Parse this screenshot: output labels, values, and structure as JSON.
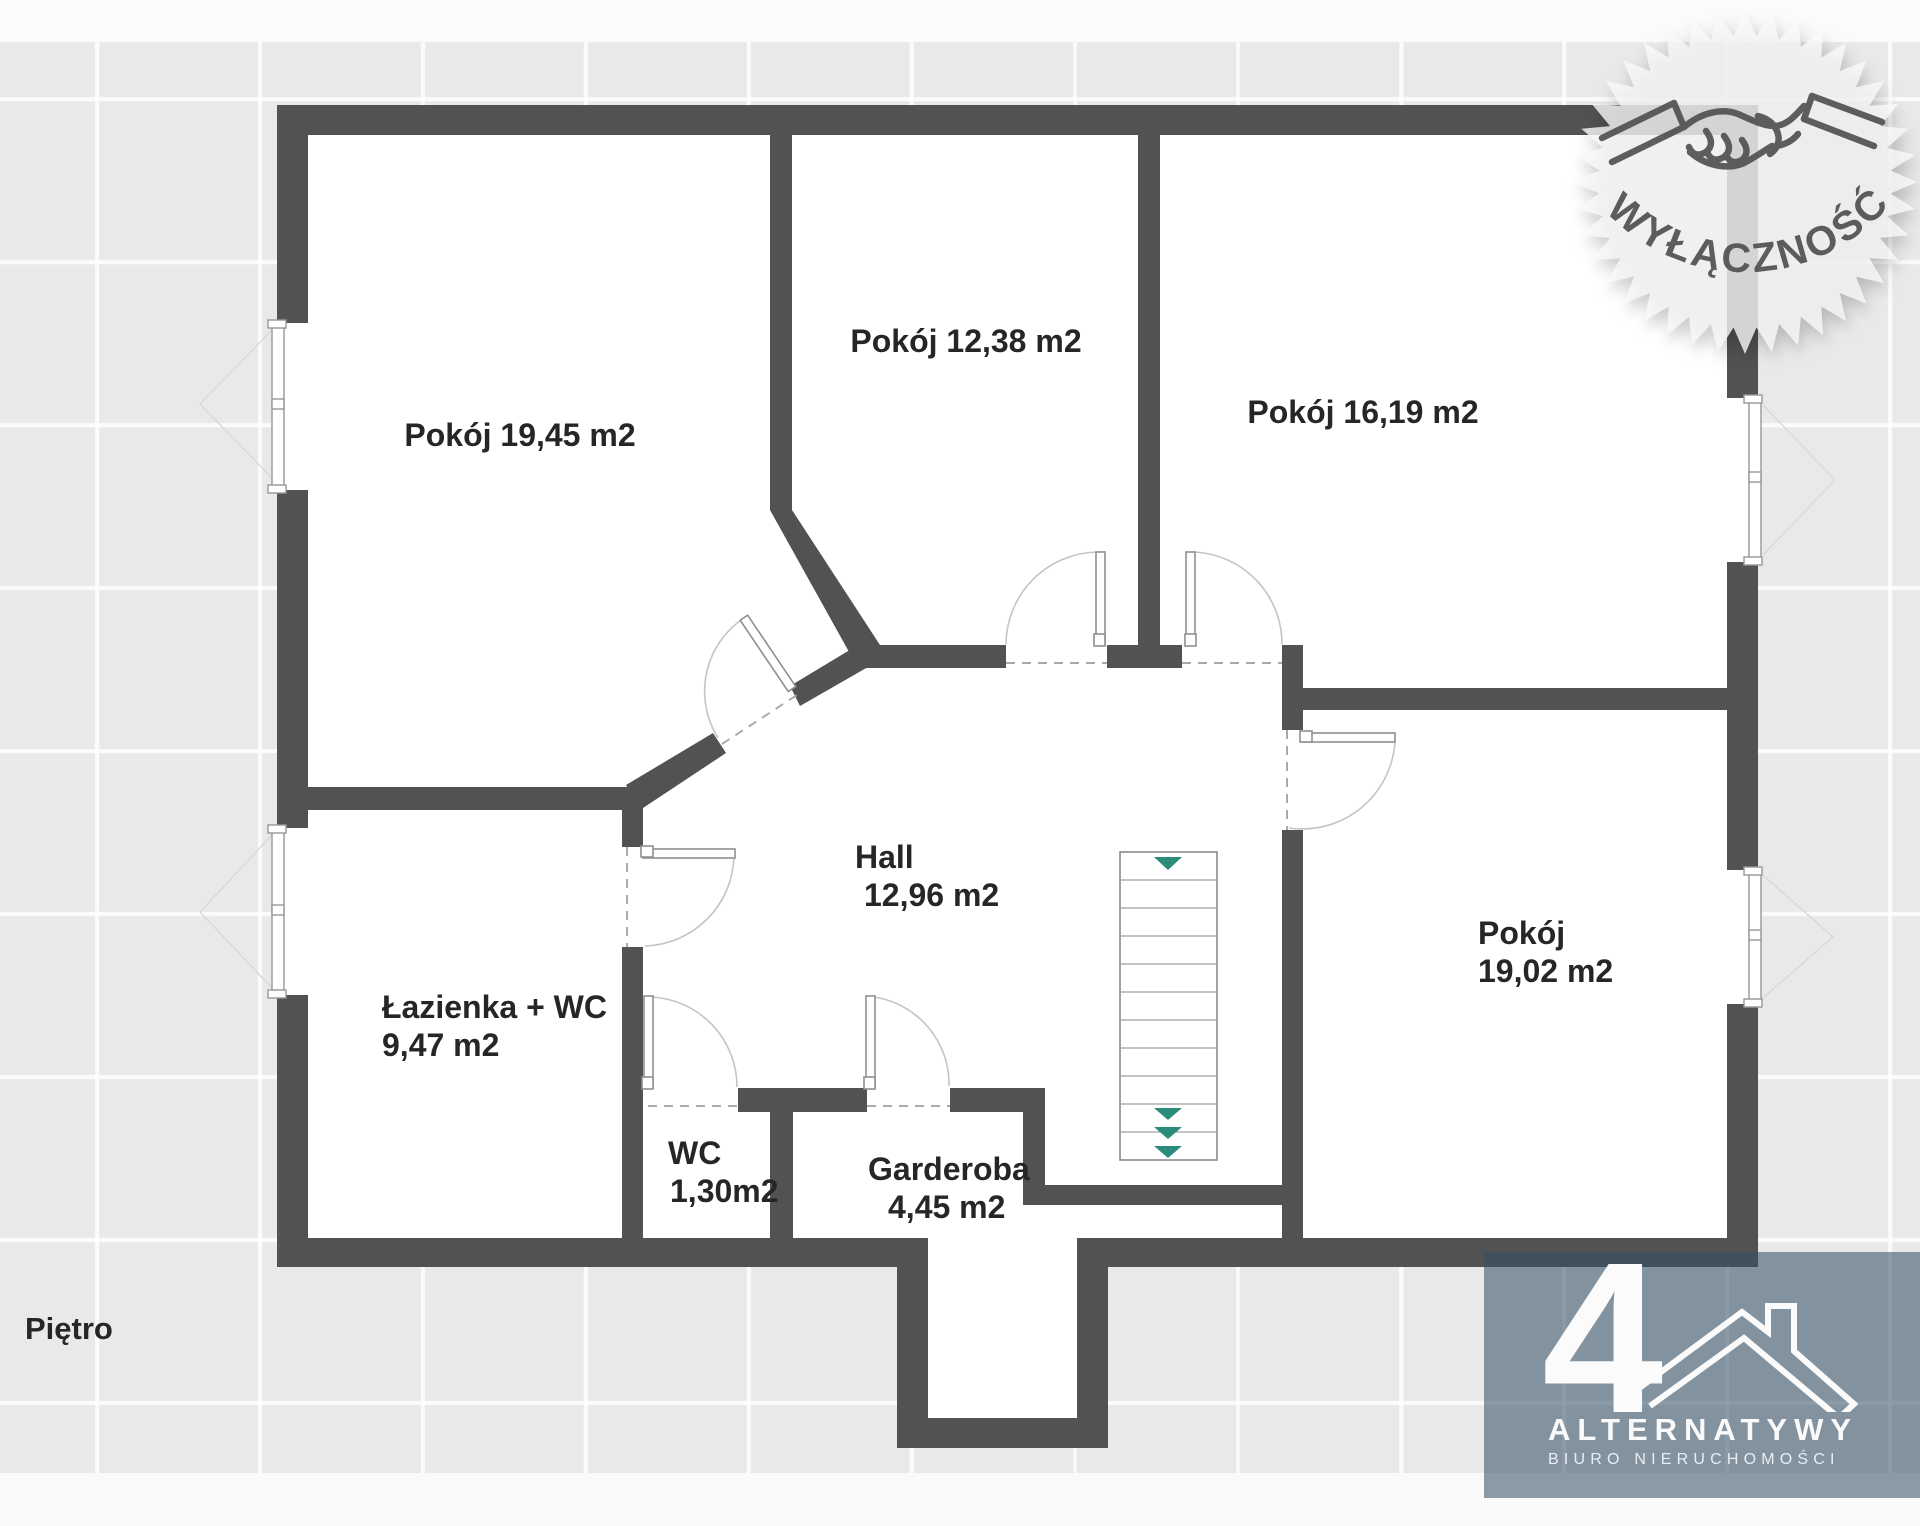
{
  "page": {
    "floor_label": "Piętro"
  },
  "rooms": {
    "pokoj1": {
      "label": "Pokój 19,45 m2"
    },
    "pokoj2": {
      "label": "Pokój 12,38 m2"
    },
    "pokoj3": {
      "label": "Pokój 16,19 m2"
    },
    "hall": {
      "name": "Hall",
      "area": "12,96 m2"
    },
    "lazienka": {
      "name": "Łazienka + WC",
      "area": "9,47 m2"
    },
    "wc": {
      "name": "WC",
      "area": "1,30m2"
    },
    "garderoba": {
      "name": "Garderoba",
      "area": "4,45 m2"
    },
    "pokoj4": {
      "name": "Pokój",
      "area": "19,02 m2"
    }
  },
  "watermark": {
    "label": "WYŁĄCZNOŚĆ",
    "icon": "handshake-icon"
  },
  "logo": {
    "symbol": "4",
    "brand": "ALTERNATYWY",
    "subtitle": "BIURO NIERUCHOMOŚCI"
  },
  "colors": {
    "wall": "#525252",
    "stair_arrow": "#2c8c7c",
    "label_text": "#262626",
    "badge_fill": "rgba(249,249,249,0.8)",
    "logo_overlay": "rgba(50,79,102,0.56)"
  }
}
